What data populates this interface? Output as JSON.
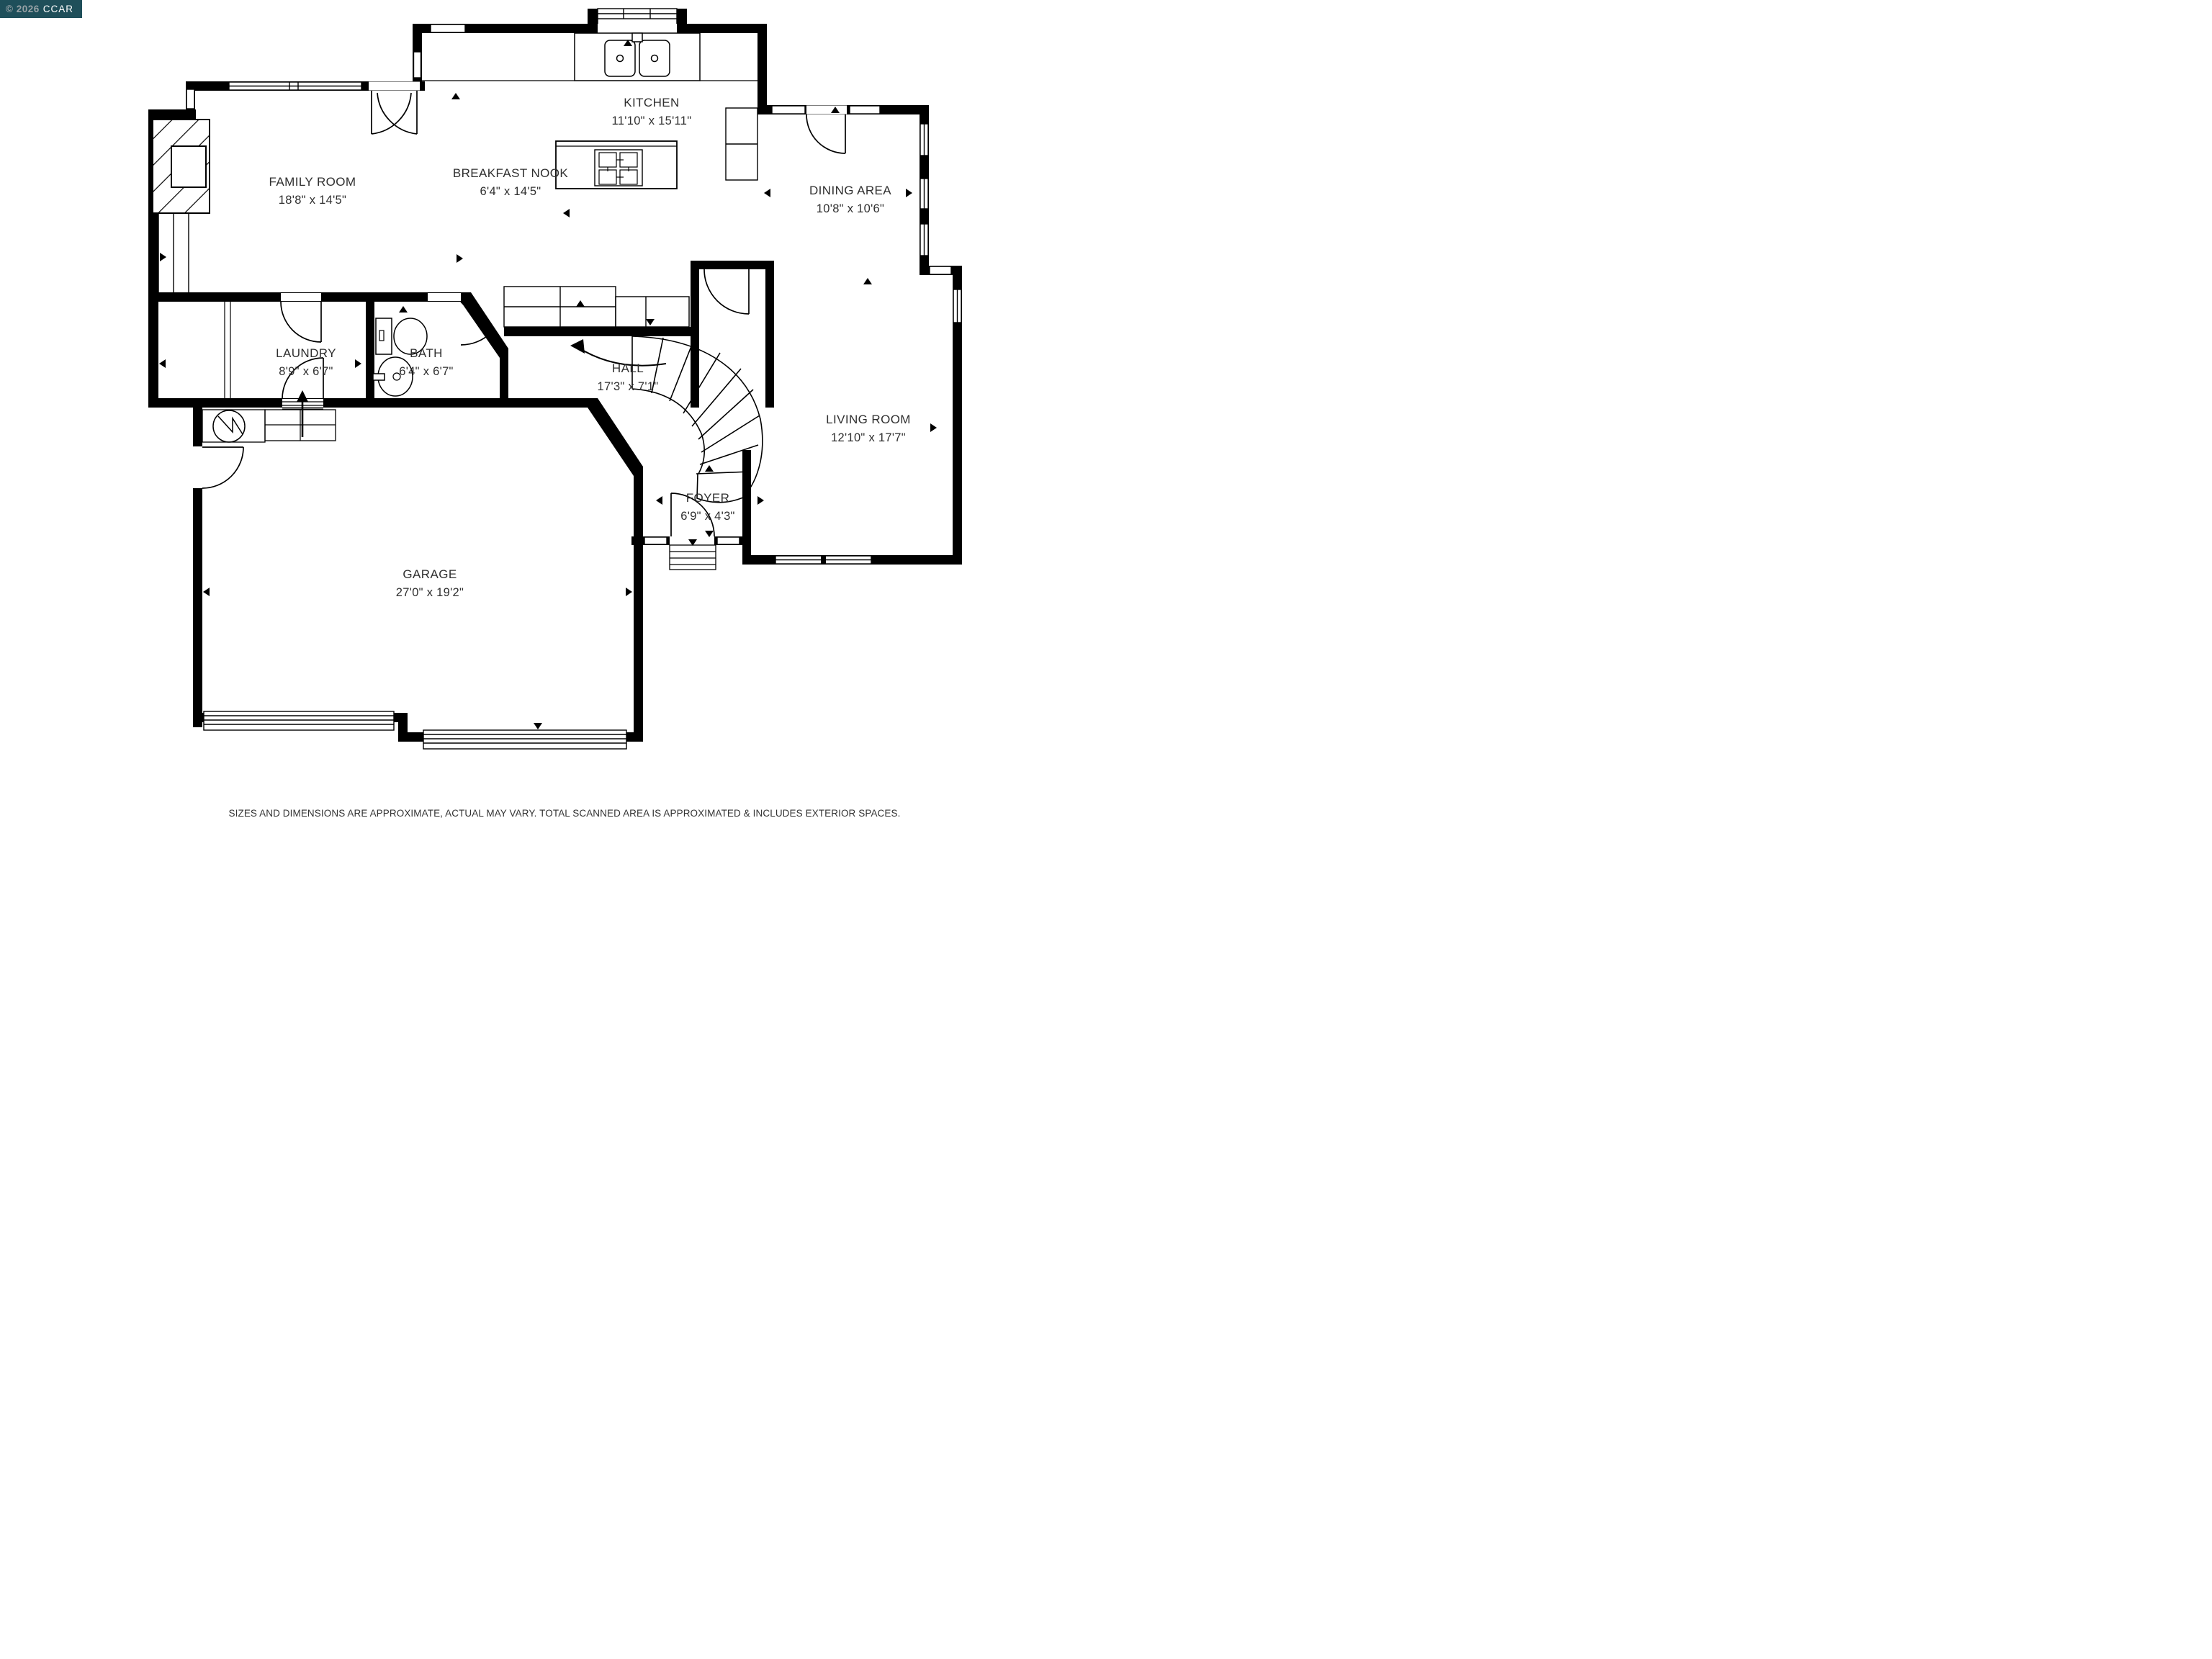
{
  "watermark": {
    "copyright": "© 2026",
    "org": "CCAR"
  },
  "rooms": [
    {
      "name": "FAMILY ROOM",
      "dims": "18'8\" x 14'5\""
    },
    {
      "name": "KITCHEN",
      "dims": "11'10\" x 15'11\""
    },
    {
      "name": "BREAKFAST NOOK",
      "dims": "6'4\" x 14'5\""
    },
    {
      "name": "DINING AREA",
      "dims": "10'8\" x 10'6\""
    },
    {
      "name": "LAUNDRY",
      "dims": "8'9\" x 6'7\""
    },
    {
      "name": "BATH",
      "dims": "6'4\" x 6'7\""
    },
    {
      "name": "HALL",
      "dims": "17'3\" x 7'1\""
    },
    {
      "name": "LIVING ROOM",
      "dims": "12'10\" x 17'7\""
    },
    {
      "name": "FOYER",
      "dims": "6'9\" x 4'3\""
    },
    {
      "name": "GARAGE",
      "dims": "27'0\" x 19'2\""
    }
  ],
  "disclaimer": "SIZES AND DIMENSIONS ARE APPROXIMATE, ACTUAL MAY VARY. TOTAL SCANNED AREA IS APPROXIMATED & INCLUDES EXTERIOR SPACES.",
  "colors": {
    "background": "#ffffff",
    "walls": "#000000",
    "label_text": "#2f2f2f",
    "watermark_bg": "#1f4f5a",
    "watermark_copyright": "#98a2a6",
    "watermark_org": "#ffffff"
  }
}
